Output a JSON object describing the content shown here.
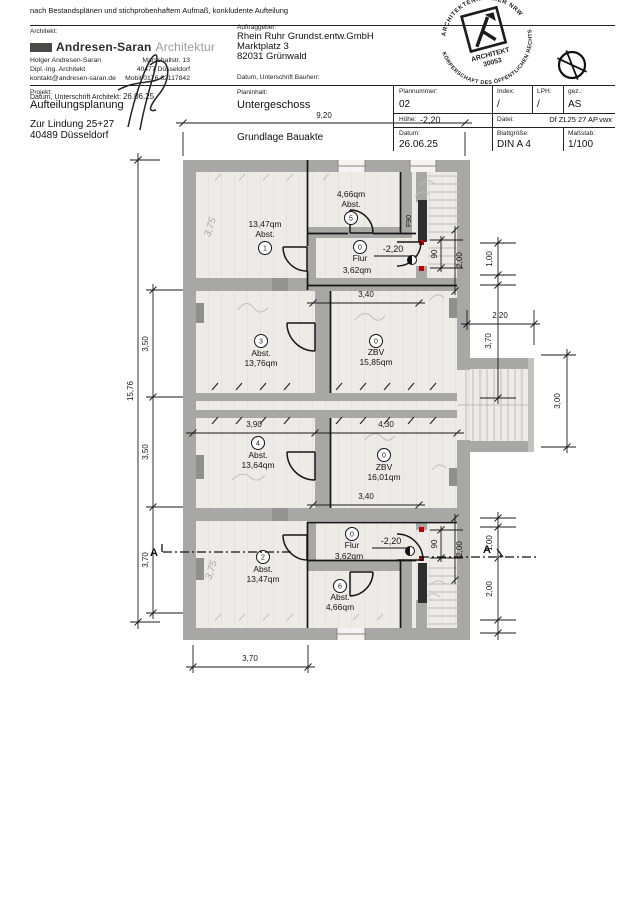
{
  "plan": {
    "rooms": [
      {
        "num": "1",
        "name": "Abst.",
        "area": "13,47qm"
      },
      {
        "num": "5",
        "name": "Abst.",
        "area": "4,66qm"
      },
      {
        "num": "0",
        "name": "Flur",
        "area": "3,62qm"
      },
      {
        "num": "3",
        "name": "Abst.",
        "area": "13,76qm"
      },
      {
        "num": "0",
        "name": "ZBV",
        "area": "15,85qm"
      },
      {
        "num": "4",
        "name": "Abst.",
        "area": "13,64qm"
      },
      {
        "num": "0",
        "name": "ZBV",
        "area": "16,01qm"
      },
      {
        "num": "2",
        "name": "Abst.",
        "area": "13,47qm"
      },
      {
        "num": "6",
        "name": "Abst.",
        "area": "4,66qm"
      },
      {
        "num": "0",
        "name": "Flur",
        "area": "3,62qm"
      }
    ],
    "dims": {
      "w_total": "9,20",
      "h_total": "15,76",
      "left_a": "3,50",
      "left_b": "3,50",
      "left_c": "3,70",
      "flur_top": "3,40",
      "flur_bottom": "3,40",
      "rooms_left": "3,90",
      "rooms_right": "4,30",
      "bottom": "3,70",
      "door_w_top": "90",
      "door_h_top": "2,00",
      "door_w_bot": "90",
      "door_h_bot": "2,00",
      "right_a": "1,00",
      "right_b": "2,20",
      "right_c": "3,70",
      "right_d": "3,00",
      "right_e": "1,00",
      "right_f": "2,00"
    },
    "levels": {
      "top": "-2,20",
      "bottom": "-2,20"
    },
    "fire_rating": "F90",
    "section_marker": "A",
    "scan_marks": [
      "3,75",
      "3,75"
    ]
  },
  "titleblock": {
    "note": "nach Bestandsplänen und stichprobenhaftem Aufmaß, konkludente Aufteilung",
    "architekt_label": "Architekt:",
    "firm": {
      "name": "Andresen-Saran",
      "suffix": "Architektur"
    },
    "contact": {
      "person": "Holger Andresen-Saran",
      "role": "Dipl.-Ing. Architekt",
      "email": "kontakt@andresen-saran.de",
      "street": "Marschallstr. 13",
      "city": "40477 Düsseldorf",
      "mobile": "Mobil 0176 62117842"
    },
    "sig_architekt_label": "Datum, Unterschrift Architekt:",
    "sig_architekt_date": "26.06.25",
    "auftraggeber_label": "Auftraggeber:",
    "client": {
      "name": "Rhein Ruhr Grundst.entw.GmbH",
      "street": "Marktplatz 3",
      "city": "82031 Grünwald"
    },
    "sig_bauherr_label": "Datum, Unterschrift Bauherr:",
    "projekt_label": "Projekt:",
    "projekt": "Aufteilungsplanung",
    "projekt_street": "Zur Lindung 25+27",
    "projekt_city": "40489 Düsseldorf",
    "planinhalt_label": "Planinhalt:",
    "planinhalt": "Untergeschoss",
    "grundlage": "Grundlage Bauakte",
    "fields": {
      "plannummer_label": "Plannummer:",
      "plannummer": "02",
      "index_label": "Index:",
      "index": "/",
      "lph_label": "LPH:",
      "lph": "/",
      "gez_label": "gez.:",
      "gez": "AS",
      "hoehe_label": "Höhe:",
      "hoehe": "-2,20",
      "datei_label": "Datei:",
      "datei": "Df ZL25 27 AP.vwx",
      "datum_label": "Datum:",
      "datum": "26.06.25",
      "blatt_label": "Blattgröße:",
      "blatt": "DIN A 4",
      "massstab_label": "Maßstab:",
      "massstab": "1/100"
    }
  },
  "stamp": {
    "arc_top": "ARCHITEKTENKAMMER NRW",
    "arc_bottom": "KÖRPERSCHAFT DES ÖFFENTLICHEN RECHTS",
    "line1": "ARCHITEKT",
    "line2": "30053"
  }
}
